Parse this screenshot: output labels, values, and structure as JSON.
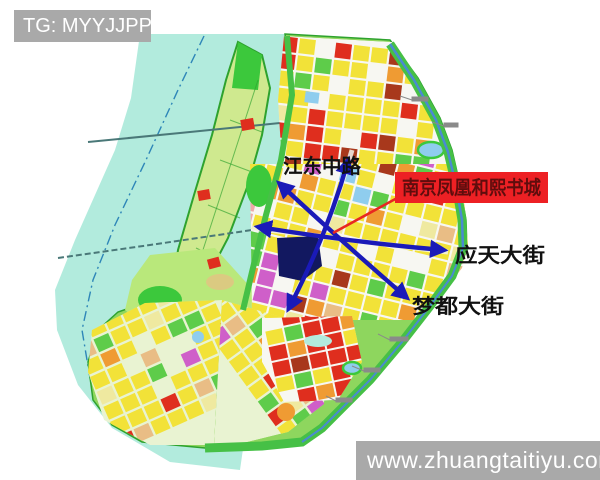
{
  "watermarks": {
    "telegram": "TG: MYYJJPP",
    "website": "www.zhuangtaitiyu.com"
  },
  "map": {
    "bookcity_label": "南京凤凰和熙书城",
    "road_labels": [
      {
        "id": "jiangdong",
        "text": "江东中路"
      },
      {
        "id": "yingtian",
        "text": "应天大街"
      },
      {
        "id": "mengdu",
        "text": "梦都大街"
      }
    ]
  },
  "colors": {
    "page_bg": "#ffffff",
    "watermark_bg": "#a9a9a9",
    "watermark_text": "#ffffff",
    "label_box_bg": "#ed2024",
    "label_box_text": "#5f0d0d",
    "road_label_text": "#111111",
    "arrow_blue": "#1a1ab8",
    "leader_red": "#e82820",
    "water": "#b2ebdd",
    "water_line": "#2e86b8",
    "island_fill": "#cfe98f",
    "island_stroke": "#2ea22e",
    "mainland_base": "#8ed65e",
    "park_green": "#3cc83c",
    "field_green": "#b9e87b",
    "street_bg": "#f7f7f2",
    "fan_street_bg": "#e9f3d2",
    "block_yellow": "#f2e238",
    "block_pale": "#efe9a0",
    "block_red": "#df2e1e",
    "block_darkred": "#a8381c",
    "block_orange": "#ef9b33",
    "block_tan": "#e9bd85",
    "block_magenta": "#cf5fc9",
    "block_pink": "#efa9a9",
    "block_blue": "#8fcdee",
    "block_green": "#5ecc4a",
    "site_block": "#121860",
    "canal_blue": "#4a8ad2",
    "boundary_green": "#46c046",
    "bridge": "#4a7878",
    "callout_gray": "#8a8a8a"
  }
}
